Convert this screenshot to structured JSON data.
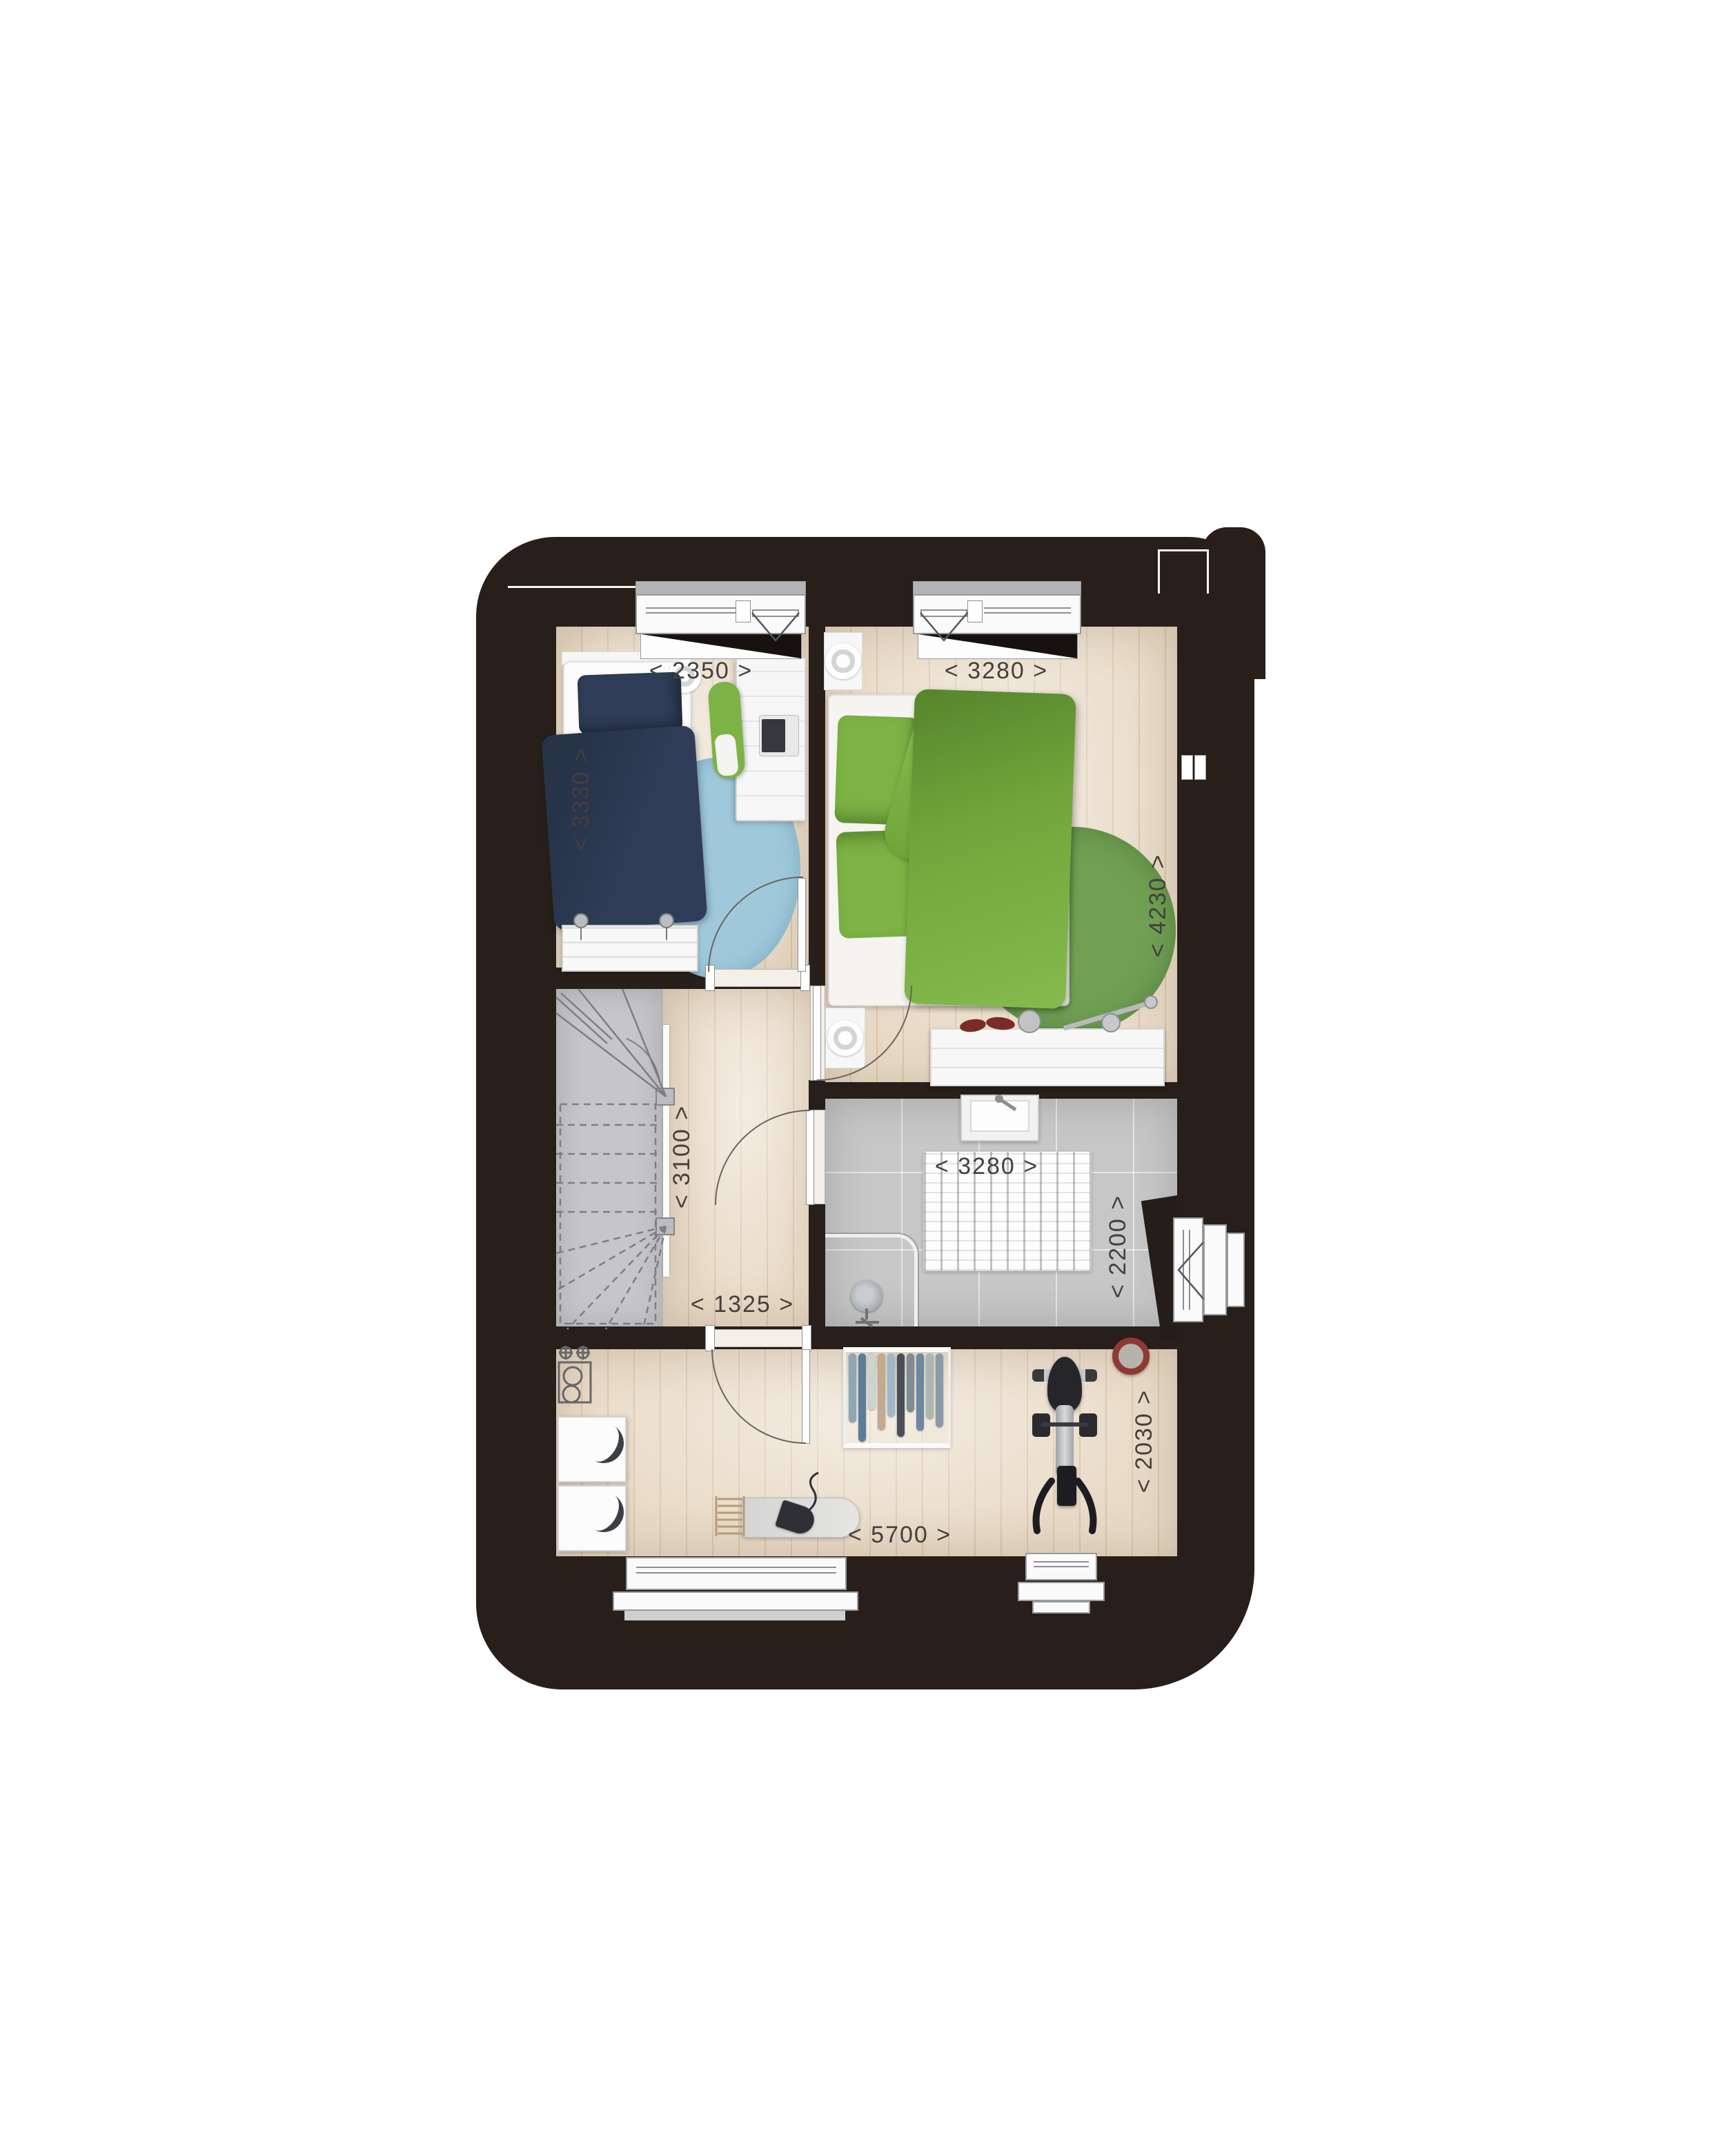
{
  "plan": {
    "type": "floor-plan",
    "floor_description": "upper storey with two bedrooms, landing with winder stair, bathroom and laundry attic room"
  },
  "dims": {
    "bedroom1_width": "< 2350 >",
    "bedroom1_depth": "< 3330 >",
    "bedroom2_width": "< 3280 >",
    "bedroom2_depth": "< 4230 >",
    "landing_depth": "< 3100 >",
    "landing_width": "< 1325 >",
    "bathroom_width": "< 3280 >",
    "bathroom_depth": "< 2200 >",
    "laundry_width": "< 5700 >",
    "laundry_depth": "< 2030 >"
  },
  "colors": {
    "wall": "#281f1a",
    "wood": "#e8dac6",
    "wood_line": "#d9c6ae",
    "tile": "#c7c7c7",
    "stair": "#c6c6c9",
    "navy": "#2f3d58",
    "navy_dark": "#273349",
    "blue_rug": "#9fc9db",
    "green": "#7db345",
    "green_dark": "#56842c",
    "green_rug": "#6fa053",
    "dim_text": "#44403c",
    "basket_red": "#8e3a33",
    "chrome": "#aeb1b5"
  },
  "laundry": {
    "rack_items": [
      {
        "c": "#8fa6b4",
        "h": 118
      },
      {
        "c": "#5b7d99",
        "h": 150
      },
      {
        "c": "#cdd3cf",
        "h": 96
      },
      {
        "c": "#c2a98f",
        "h": 130
      },
      {
        "c": "#9fb7c8",
        "h": 108
      },
      {
        "c": "#4a4f57",
        "h": 142
      },
      {
        "c": "#7f8b96",
        "h": 100
      },
      {
        "c": "#6e87a0",
        "h": 132
      },
      {
        "c": "#aab6b0",
        "h": 112
      },
      {
        "c": "#8a9aa8",
        "h": 126
      }
    ]
  }
}
